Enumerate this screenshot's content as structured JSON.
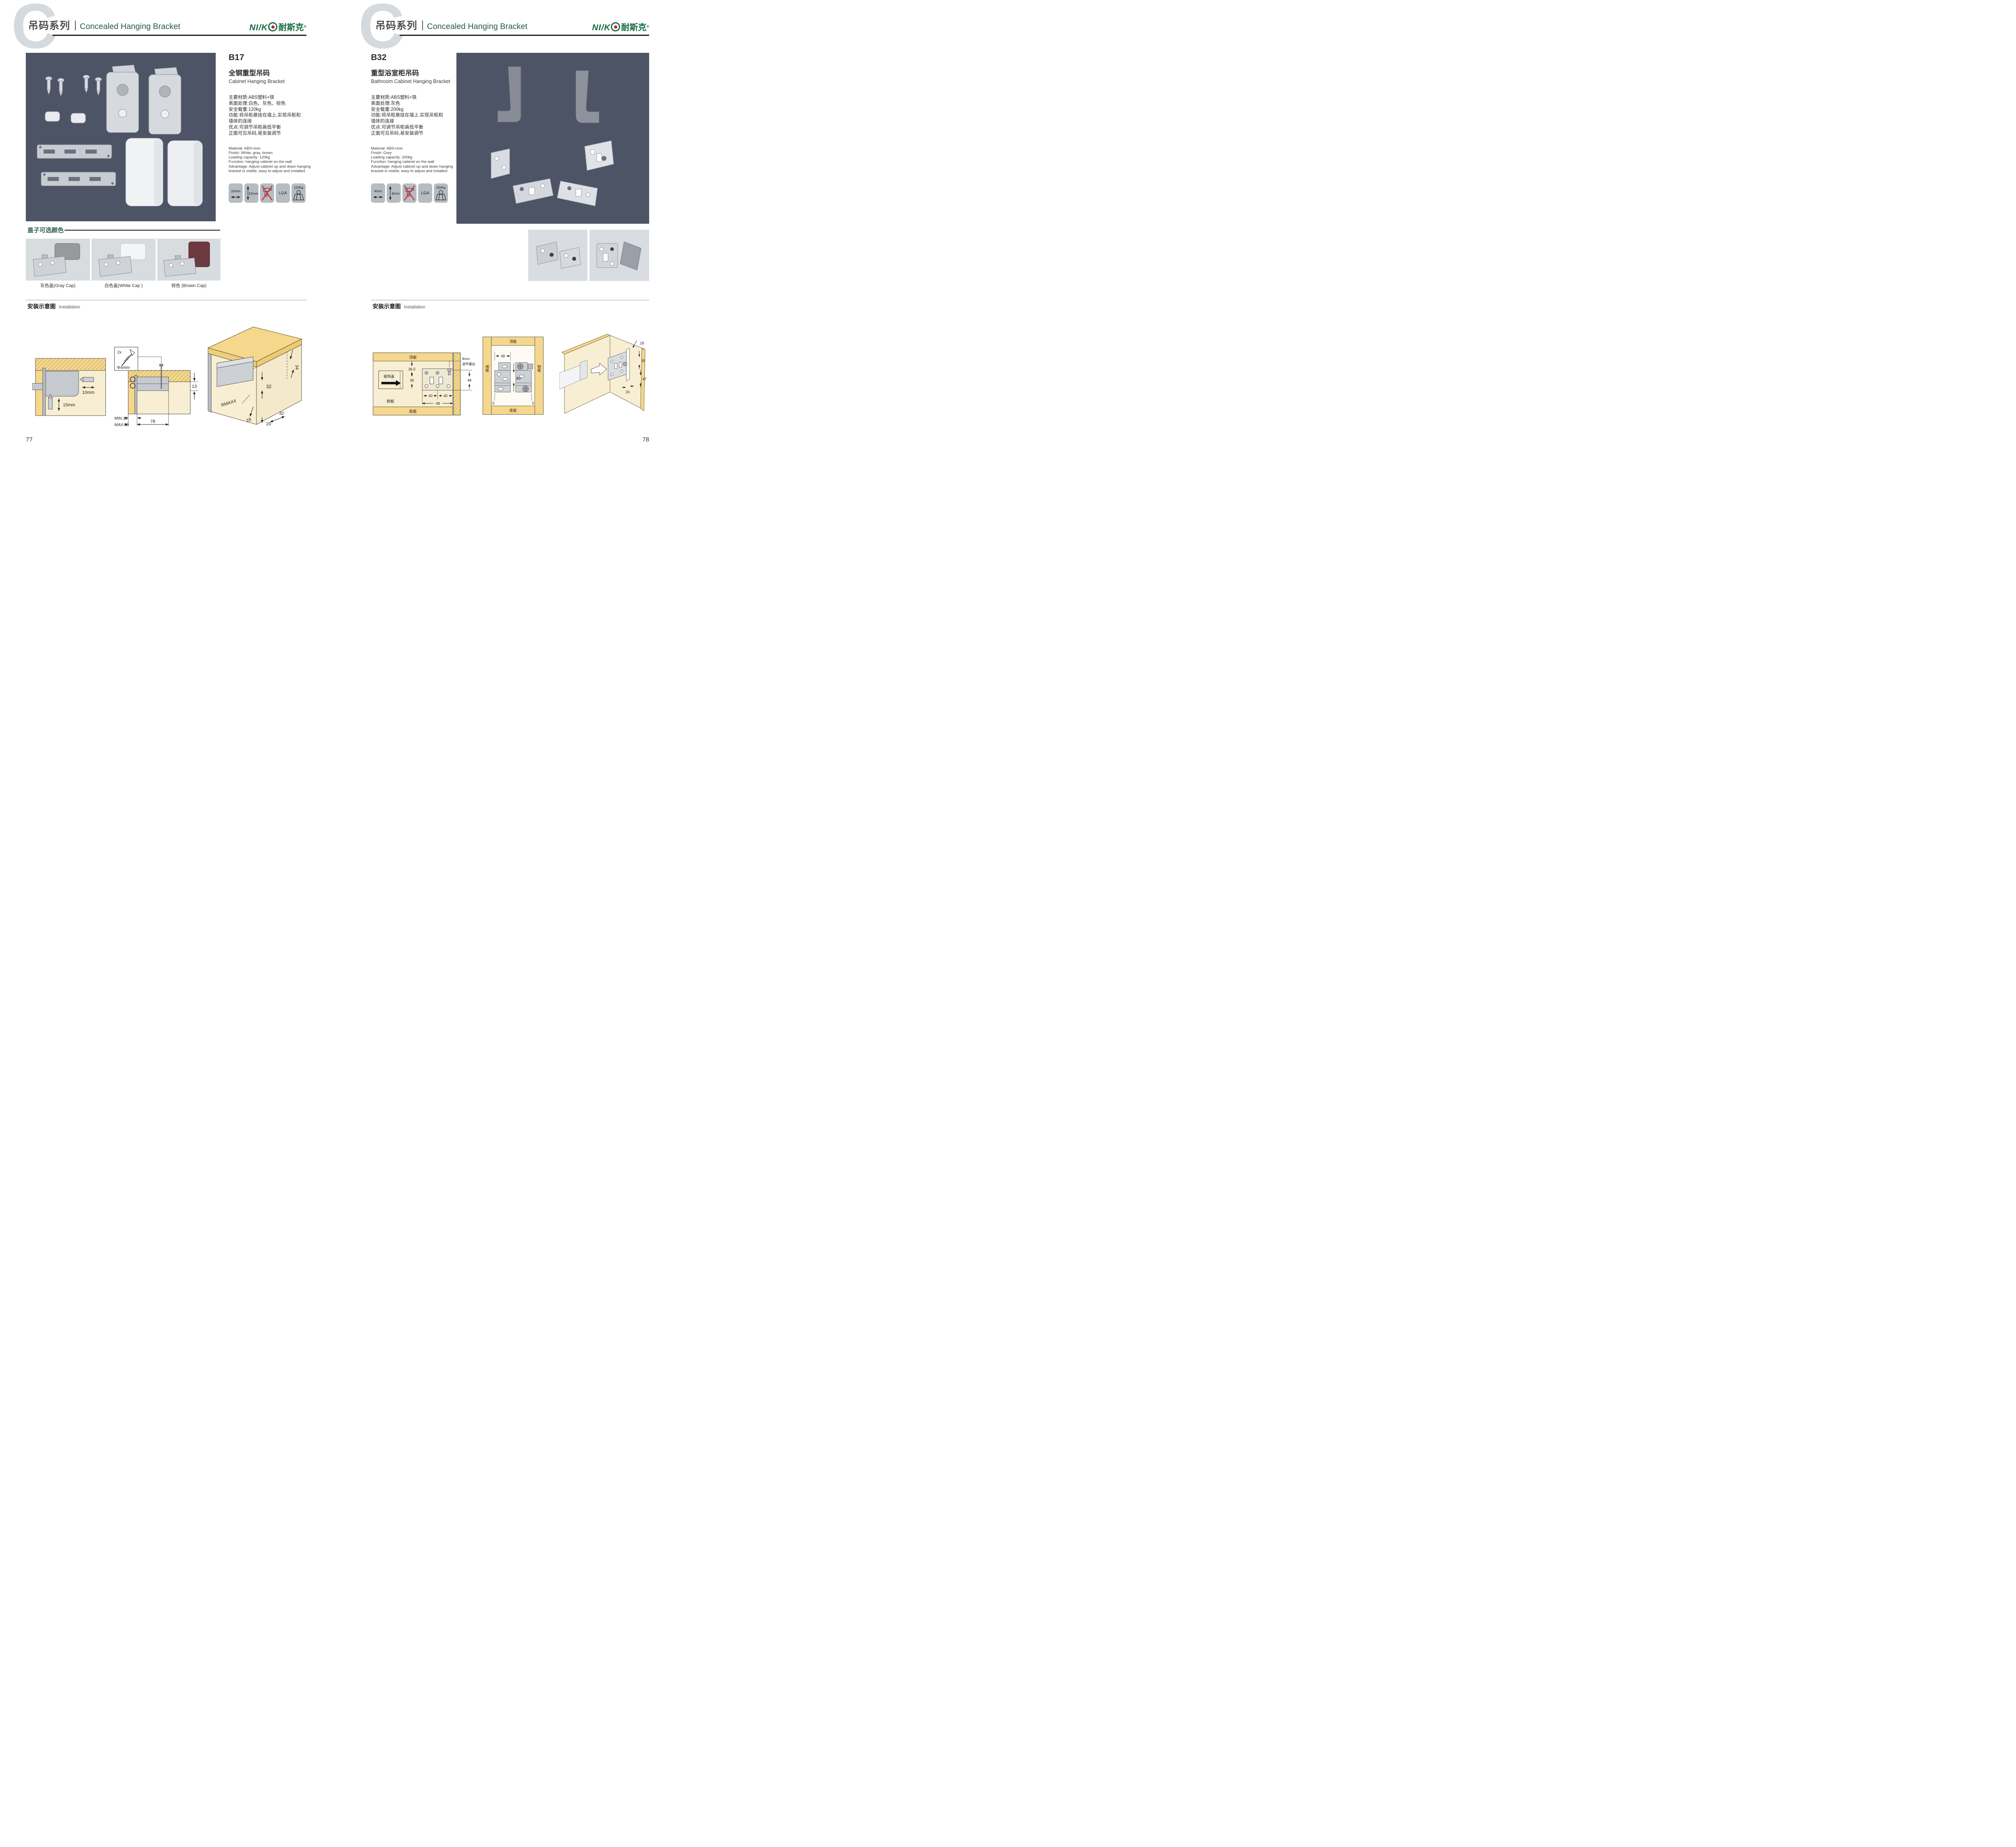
{
  "colors": {
    "brand_green": "#156b42",
    "logo_dot_red": "#cc2127",
    "photo_bg": "#4d5466",
    "accent_green": "#2e5d4b",
    "wood_yellow": "#f6d88d",
    "panel_cream": "#f8eed3"
  },
  "brand": {
    "logo_latin": "NI/K",
    "logo_zh": "耐斯克",
    "registered": "®"
  },
  "header": {
    "watermark": "C",
    "series_zh": "吊码系列",
    "series_en": "Concealed Hanging Bracket"
  },
  "page_left": {
    "page_number": "77",
    "product": {
      "code": "B17",
      "name_zh": "全钢重型吊码",
      "name_en": "Cabinet Hanging Bracket",
      "specs_zh": [
        "主要材质:ABS塑料+铁",
        "表面处理:白色、灰色、棕色",
        "安全载重:120kg",
        "功能:将吊柜悬挂在墙上,实现吊柜和",
        "墙体的连接",
        "优点:可调节吊柜高低平衡",
        "正面可见吊码,易安装调节"
      ],
      "specs_en": [
        "Material: ABS+iron",
        "Finish: White, gray, brown",
        "Loading capacity: 120kg",
        "Function: hanging cabinet on the wall",
        "Advantage: Adjust cabinet up and down hanging",
        "bracket is visible, easy to adjust and installed"
      ],
      "icon_labels": {
        "width": "10mm",
        "height": "15mm",
        "cert": "LGA",
        "load": "120Kg"
      }
    },
    "caps": {
      "title": "盖子可选颜色",
      "captions": [
        "灰色盖(Gray Cap)",
        "白色盖(White Cap )",
        "棕色 (Brown Cap)"
      ]
    },
    "installation": {
      "title_zh": "安装示意图",
      "title_en": "Installation",
      "d1": {
        "h": "10mm",
        "v": "15mm"
      },
      "d2": {
        "qty": "2x",
        "dia": "Φ4mm",
        "t": "13",
        "min": "MIN.10",
        "max": "MAX.30",
        "w": "78"
      },
      "d3": {
        "a": "34",
        "b": "32",
        "r": "RMAX4",
        "c": "18",
        "d": "20",
        "e": "32"
      }
    }
  },
  "page_right": {
    "page_number": "78",
    "product": {
      "code": "B32",
      "name_zh": "重型浴室柜吊码",
      "name_en": "Bathroom Cabinet Hanging Bracket",
      "specs_zh": [
        "主要材质:ABS塑料+铁",
        "表面处理:灰色",
        "安全载重:200kg",
        "功能:将吊柜悬挂在墙上,实现吊柜和",
        "墙体的连接",
        "优点:可调节吊柜高低平衡",
        "正面可见吊码,易安装调节"
      ],
      "specs_en": [
        "Material: ABS+iron",
        "Finish: Grey",
        "Loading capacity: 200kg",
        "Function: hanging cabinet on the wall",
        "Advantage: Adjust cabinet up and down hanging",
        "bracket is visible, easy to adjust and installed"
      ],
      "icon_labels": {
        "width": "4mm",
        "height": "8mm",
        "cert": "LGA",
        "load": "200Kg"
      }
    },
    "installation": {
      "title_zh": "安装示意图",
      "title_en": "Installation",
      "d1": {
        "top": "顶板",
        "a": "36.5",
        "b": "36",
        "cover": "装饰盖",
        "s1": "8mm",
        "s2": "调节螺丝",
        "h": "48",
        "w1": "40",
        "w2": "40",
        "w3": "98",
        "side": "侧板",
        "bottom": "底板"
      },
      "d2": {
        "top": "顶板",
        "w": "48",
        "h": "80",
        "sl": "侧板",
        "sr": "侧板",
        "bottom": "底板",
        "ol": "5",
        "or": "5"
      },
      "d3": {
        "a": "18",
        "b": "35",
        "c": "47",
        "d": "24"
      }
    }
  }
}
